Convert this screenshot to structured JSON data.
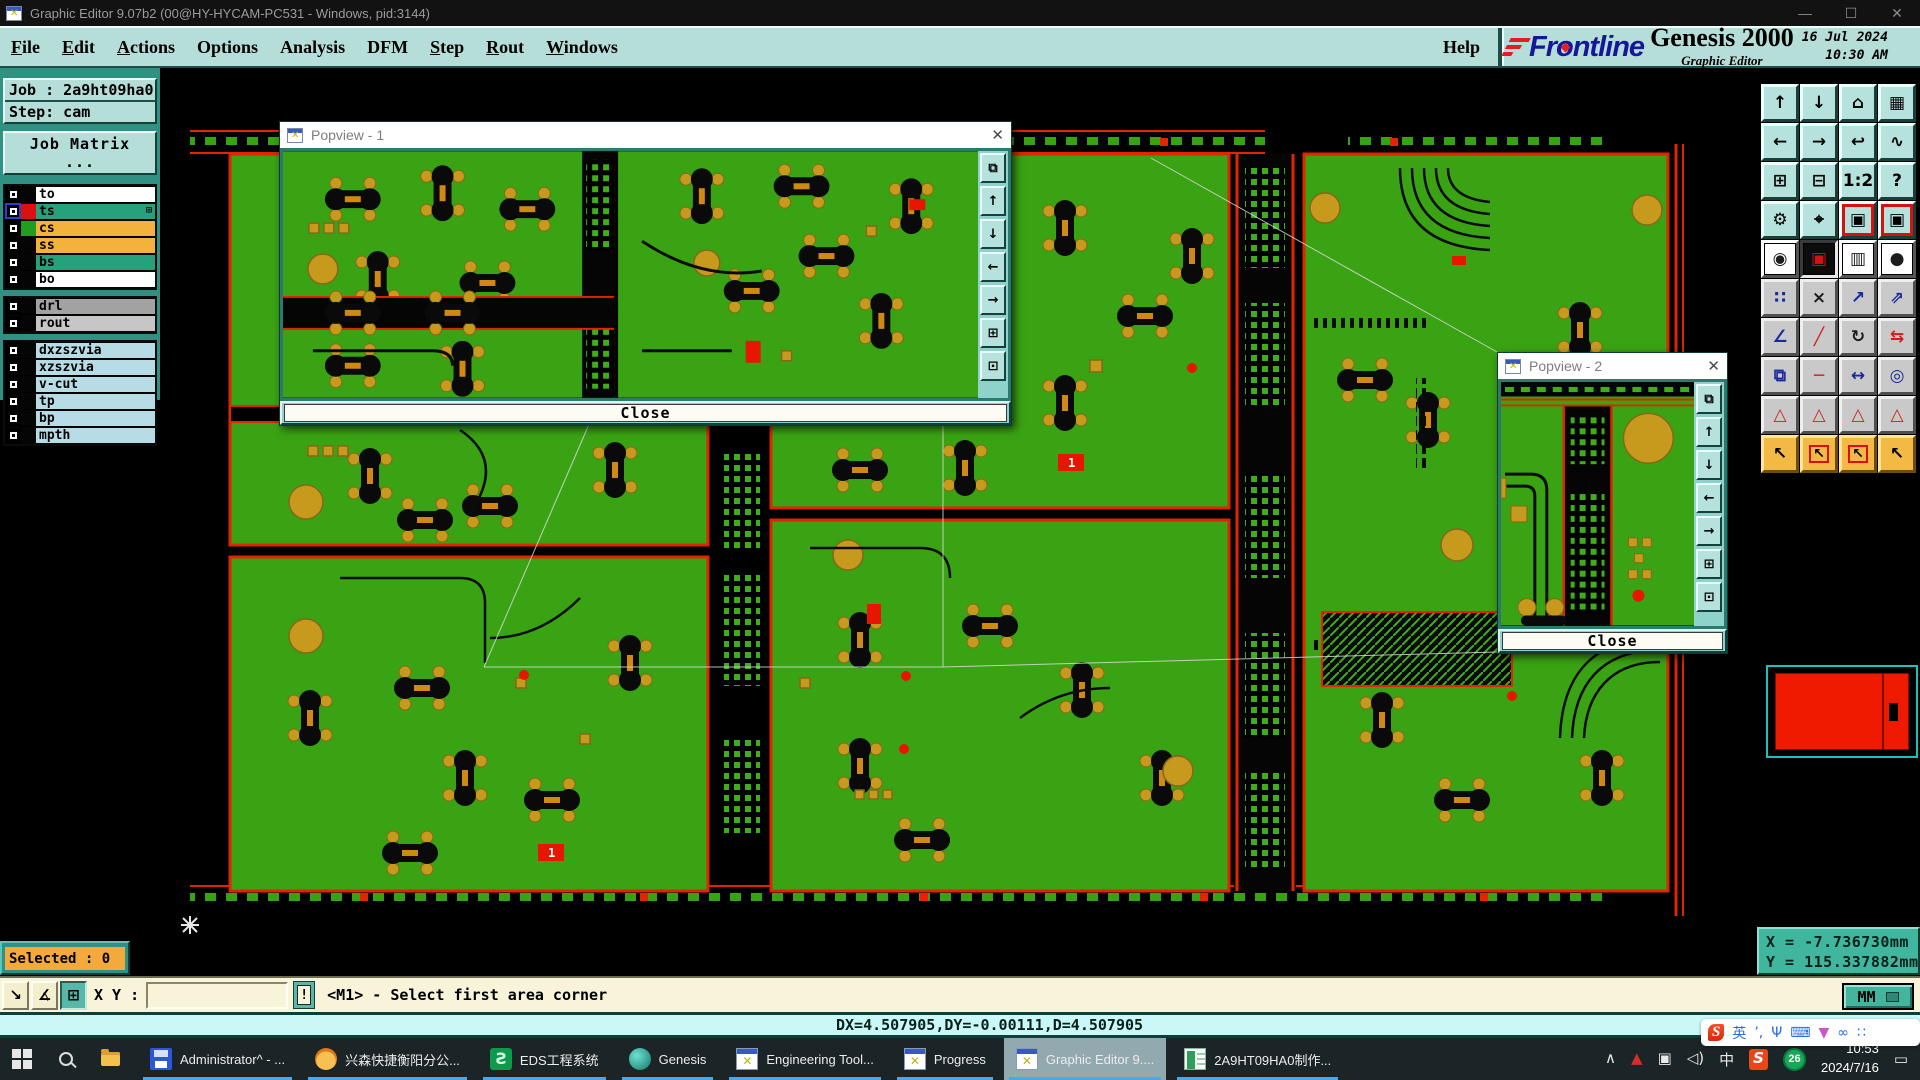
{
  "window": {
    "title": "Graphic Editor 9.07b2 (00@HY-HYCAM-PC531 - Windows, pid:3144)",
    "controls": {
      "min": "—",
      "max": "☐",
      "close": "✕"
    }
  },
  "menu": {
    "items": [
      {
        "label": "File",
        "u": "u"
      },
      {
        "label": "Edit",
        "u": "u"
      },
      {
        "label": "Actions",
        "u": "u"
      },
      {
        "label": "Options",
        "u": ""
      },
      {
        "label": "Analysis",
        "u": ""
      },
      {
        "label": "DFM",
        "u": ""
      },
      {
        "label": "Step",
        "u": "u"
      },
      {
        "label": "Rout",
        "u": "u"
      },
      {
        "label": "Windows",
        "u": "u"
      }
    ],
    "help": "Help"
  },
  "branding": {
    "logo_pre": "Fr",
    "logo_o": "o",
    "logo_post": "ntline",
    "product": "Genesis 2000",
    "edition": "Graphic Editor",
    "date": "16 Jul 2024",
    "time": "10:30 AM"
  },
  "job": {
    "job_line": "Job : 2a9ht09ha0",
    "step_line": "Step: cam",
    "matrix_button": "Job Matrix ..."
  },
  "layers": {
    "board": [
      {
        "name": "to",
        "swatch": "#050505",
        "bg": "#ffffff",
        "active": "",
        "grid_glyph": ""
      },
      {
        "name": "ts",
        "swatch": "#dd1010",
        "bg": "#27a07c",
        "active": "active",
        "grid_glyph": "⊞"
      },
      {
        "name": "cs",
        "swatch": "#1f9e1f",
        "bg": "#f2b23c",
        "active": "",
        "grid_glyph": ""
      },
      {
        "name": "ss",
        "swatch": "#050505",
        "bg": "#f2b23c",
        "active": "",
        "grid_glyph": ""
      },
      {
        "name": "bs",
        "swatch": "#050505",
        "bg": "#27a07c",
        "active": "",
        "grid_glyph": ""
      },
      {
        "name": "bo",
        "swatch": "#050505",
        "bg": "#ffffff",
        "active": "",
        "grid_glyph": ""
      }
    ],
    "drill": [
      {
        "name": "drl",
        "swatch": "#050505",
        "bg": "#a2a2a2",
        "active": "",
        "grid_glyph": ""
      },
      {
        "name": "rout",
        "swatch": "#050505",
        "bg": "#c6c6c6",
        "active": "",
        "grid_glyph": ""
      }
    ],
    "aux": [
      {
        "name": "dxzszvia",
        "swatch": "#050505",
        "bg": "#b8dce6",
        "active": "",
        "grid_glyph": ""
      },
      {
        "name": "xzszvia",
        "swatch": "#050505",
        "bg": "#b8dce6",
        "active": "",
        "grid_glyph": ""
      },
      {
        "name": "v-cut",
        "swatch": "#050505",
        "bg": "#b8dce6",
        "active": "",
        "grid_glyph": ""
      },
      {
        "name": "tp",
        "swatch": "#050505",
        "bg": "#b8dce6",
        "active": "",
        "grid_glyph": ""
      },
      {
        "name": "bp",
        "swatch": "#050505",
        "bg": "#b8dce6",
        "active": "",
        "grid_glyph": ""
      },
      {
        "name": "mpth",
        "swatch": "#050505",
        "bg": "#b8dce6",
        "active": "",
        "grid_glyph": ""
      }
    ]
  },
  "popview1": {
    "title": "Popview - 1",
    "close_label": "Close",
    "x": "✕"
  },
  "popview2": {
    "title": "Popview - 2",
    "close_label": "Close",
    "x": "✕"
  },
  "popview_icons": [
    {
      "name": "new-window-icon",
      "glyph": "⧉"
    },
    {
      "name": "pan-up-icon",
      "glyph": "↑"
    },
    {
      "name": "pan-down-icon",
      "glyph": "↓"
    },
    {
      "name": "pan-left-icon",
      "glyph": "←"
    },
    {
      "name": "pan-right-icon",
      "glyph": "→"
    },
    {
      "name": "zoom-contract-icon",
      "glyph": "⊞"
    },
    {
      "name": "zoom-expand-icon",
      "glyph": "⊡"
    }
  ],
  "toolbar": {
    "buttons": [
      {
        "name": "pan-up-button",
        "glyph": "↑",
        "variant": "teal"
      },
      {
        "name": "pan-down-button",
        "glyph": "↓",
        "variant": "teal"
      },
      {
        "name": "home-view-button",
        "glyph": "⌂",
        "variant": "teal"
      },
      {
        "name": "window-xy-button",
        "glyph": "▦",
        "variant": "teal"
      },
      {
        "name": "pan-left-button",
        "glyph": "←",
        "variant": "teal"
      },
      {
        "name": "pan-right-button",
        "glyph": "→",
        "variant": "teal"
      },
      {
        "name": "previous-view-button",
        "glyph": "↩",
        "variant": "teal"
      },
      {
        "name": "serpentine-view-button",
        "glyph": "∿",
        "variant": "teal"
      },
      {
        "name": "zoom-in-button",
        "glyph": "⊞",
        "variant": "teal"
      },
      {
        "name": "zoom-out-button",
        "glyph": "⊟",
        "variant": "teal"
      },
      {
        "name": "scale-1-2-button",
        "glyph": "1:2",
        "variant": "teal"
      },
      {
        "name": "help-button",
        "glyph": "?",
        "variant": "teal"
      },
      {
        "name": "setup-tools-button",
        "glyph": "⚙",
        "variant": "teal"
      },
      {
        "name": "origin-target-button",
        "glyph": "⌖",
        "variant": "teal"
      },
      {
        "name": "popview-1-button",
        "glyph": "▣",
        "variant": "teal rf"
      },
      {
        "name": "popview-2-button",
        "glyph": "▣",
        "variant": "teal rf"
      },
      {
        "name": "select-feature-button",
        "glyph": "◉",
        "variant": "white darkg"
      },
      {
        "name": "active-selection-button",
        "glyph": "▣",
        "variant": "white pressed"
      },
      {
        "name": "ruler-button",
        "glyph": "▥",
        "variant": "white darkg"
      },
      {
        "name": "pad-highlight-button",
        "glyph": "●",
        "variant": "white darkg"
      },
      {
        "name": "net-chain-button",
        "glyph": "∷",
        "variant": "gray"
      },
      {
        "name": "delete-feature-button",
        "glyph": "×",
        "variant": "gray darkg"
      },
      {
        "name": "copy-to-layer-button",
        "glyph": "↗",
        "variant": "gray"
      },
      {
        "name": "move-to-layer-button",
        "glyph": "⇗",
        "variant": "gray"
      },
      {
        "name": "angle-measure-button",
        "glyph": "∠",
        "variant": "gray"
      },
      {
        "name": "draw-line-button",
        "glyph": "╱",
        "variant": "gray redg"
      },
      {
        "name": "rotate-button",
        "glyph": "↻",
        "variant": "gray darkg"
      },
      {
        "name": "mirror-button",
        "glyph": "⇆",
        "variant": "gray redg"
      },
      {
        "name": "transform-copy-button",
        "glyph": "⧉",
        "variant": "gray"
      },
      {
        "name": "break-element-button",
        "glyph": "─",
        "variant": "gray redg"
      },
      {
        "name": "measure-distance-button",
        "glyph": "↔",
        "variant": "gray"
      },
      {
        "name": "merge-shapes-button",
        "glyph": "◎",
        "variant": "gray"
      },
      {
        "name": "arc-mode-1-button",
        "glyph": "△",
        "variant": "gray redg"
      },
      {
        "name": "arc-mode-2-button",
        "glyph": "△",
        "variant": "gray redg"
      },
      {
        "name": "arc-mode-3-button",
        "glyph": "△",
        "variant": "gray redg"
      },
      {
        "name": "arc-mode-4-button",
        "glyph": "△",
        "variant": "gray redg"
      },
      {
        "name": "select-pointer-button",
        "glyph": "↖",
        "variant": "orange"
      },
      {
        "name": "frame-select-button",
        "glyph": "↖",
        "variant": "orange rbox"
      },
      {
        "name": "polygon-select-button",
        "glyph": "↖",
        "variant": "orange rbox"
      },
      {
        "name": "net-select-button",
        "glyph": "↖",
        "variant": "orange"
      }
    ]
  },
  "status": {
    "selected": "Selected : 0",
    "xy_label": "X Y :",
    "input_value": "",
    "excl": "!",
    "prompt": "<M1> - Select first area corner",
    "units": "MM",
    "buttons": [
      {
        "name": "zoom-window-button",
        "glyph": "↘",
        "variant": ""
      },
      {
        "name": "snap-mode-button",
        "glyph": "∡",
        "variant": ""
      },
      {
        "name": "tile-view-button",
        "glyph": "⊞",
        "variant": "pressed-teal"
      }
    ]
  },
  "coords": {
    "x_line": "X = -7.736730mm",
    "y_line": "Y = 115.337882mm"
  },
  "delta_bar": "DX=4.507905,DY=-0.00111,D=4.507905",
  "canvas": {
    "board_labels": [
      "1",
      "1"
    ]
  },
  "taskbar": {
    "tasks": [
      {
        "label": "Administrator^ - ...",
        "icon": "ti-floppy",
        "active": ""
      },
      {
        "label": "兴森快捷衡阳分公...",
        "icon": "ti-shell",
        "active": ""
      },
      {
        "label": "EDS工程系统",
        "icon": "ti-eds",
        "active": ""
      },
      {
        "label": "Genesis",
        "icon": "ti-genesis",
        "active": ""
      },
      {
        "label": "Engineering Tool...",
        "icon": "ti-xwin",
        "active": ""
      },
      {
        "label": "Progress",
        "icon": "ti-xwin",
        "active": ""
      },
      {
        "label": "Graphic Editor 9....",
        "icon": "ti-xwin",
        "active": "active"
      },
      {
        "label": "2A9HT09HA0制作...",
        "icon": "ti-excel",
        "active": ""
      }
    ],
    "tray_icons": [
      {
        "name": "tray-expand-icon",
        "glyph": "∧",
        "cls": ""
      },
      {
        "name": "anydesk-icon",
        "glyph": "▲",
        "cls": "red"
      },
      {
        "name": "snip-icon",
        "glyph": "▣",
        "cls": ""
      },
      {
        "name": "volume-icon",
        "glyph": "◁)",
        "cls": ""
      },
      {
        "name": "ime-icon",
        "glyph": "中",
        "cls": ""
      },
      {
        "name": "sogou-tray-icon",
        "glyph": "S",
        "cls": "sogou"
      }
    ],
    "badge": "26",
    "time": "10:53",
    "date": "2024/7/16",
    "notification_glyph": "▭"
  },
  "sogou_bar": [
    {
      "name": "sogou-s-icon",
      "glyph": "S",
      "cls": "slogo"
    },
    {
      "name": "lang-icon",
      "glyph": "英",
      "cls": ""
    },
    {
      "name": "punct-icon",
      "glyph": "’,",
      "cls": ""
    },
    {
      "name": "mic-icon",
      "glyph": "Ψ",
      "cls": ""
    },
    {
      "name": "keyboard-icon",
      "glyph": "⌨",
      "cls": ""
    },
    {
      "name": "skin-icon",
      "glyph": "▼",
      "cls": "pink"
    },
    {
      "name": "game-icon",
      "glyph": "∞",
      "cls": ""
    },
    {
      "name": "apps-icon",
      "glyph": "∷",
      "cls": ""
    }
  ]
}
